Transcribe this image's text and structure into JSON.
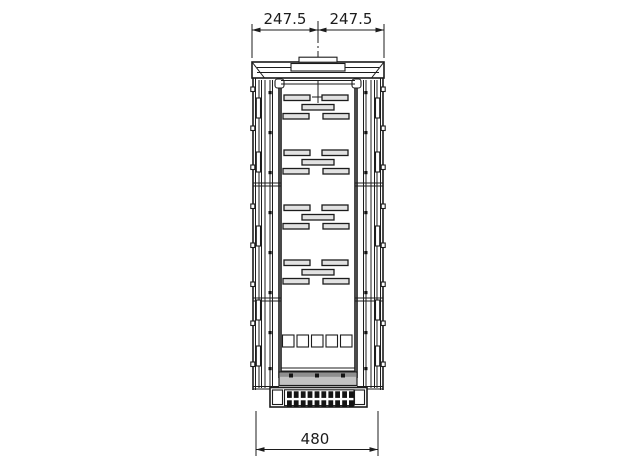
{
  "drawing": {
    "name": "cabinet-frame-front-view-technical-drawing",
    "background_color": "#ffffff",
    "line_color": "#1c1c1c",
    "slot_fill_color": "#e2e2e2",
    "rail_fill_color": "#c2c2c2",
    "louver_fill_color": "#141414",
    "dimensions": {
      "top_left": "247.5",
      "top_right": "247.5",
      "bottom": "480"
    },
    "features": {
      "slot_group_count": 4,
      "slots_per_group": 5,
      "bottom_square_count": 5,
      "louver_group_count": 5,
      "side_post_notch_count": 8
    }
  }
}
